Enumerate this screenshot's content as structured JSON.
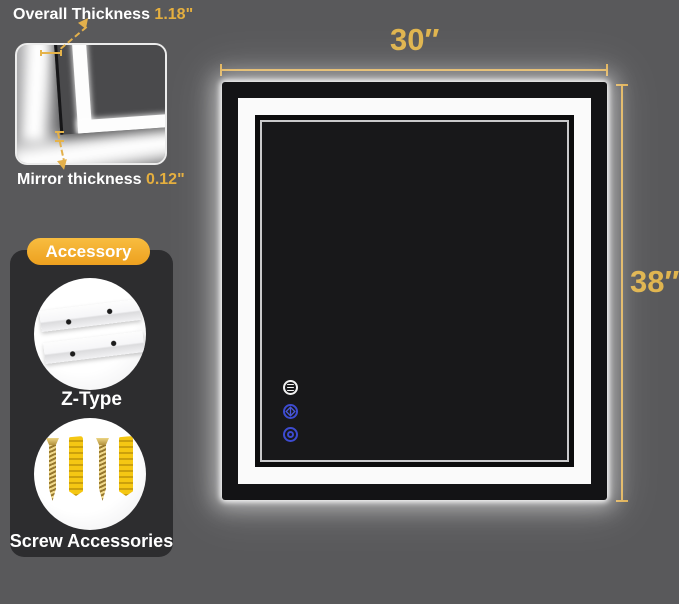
{
  "callouts": {
    "overall": {
      "label": "Overall Thickness",
      "value": "1.18\""
    },
    "mirror": {
      "label": "Mirror thickness",
      "value": "0.12\""
    }
  },
  "accessory": {
    "badge": "Accessory",
    "items": [
      {
        "name": "z-type-bracket",
        "label": "Z-Type"
      },
      {
        "name": "screw-accessories",
        "label": "Screw Accessories"
      }
    ]
  },
  "dimensions": {
    "width_label": "30″",
    "height_label": "38″"
  },
  "touch_buttons": [
    {
      "name": "light-setting",
      "color": "#f2f2f2"
    },
    {
      "name": "defog",
      "color": "#3d4bd0"
    },
    {
      "name": "power",
      "color": "#3d4bd0"
    }
  ],
  "colors": {
    "background": "#59595b",
    "panel": "#2d2d2f",
    "gold_accent": "#e0b54f",
    "badge_gold": "#f0ab2c",
    "button_blue": "#3d4bd0",
    "mirror_frame": "#131315",
    "led_band": "#fafafa"
  }
}
